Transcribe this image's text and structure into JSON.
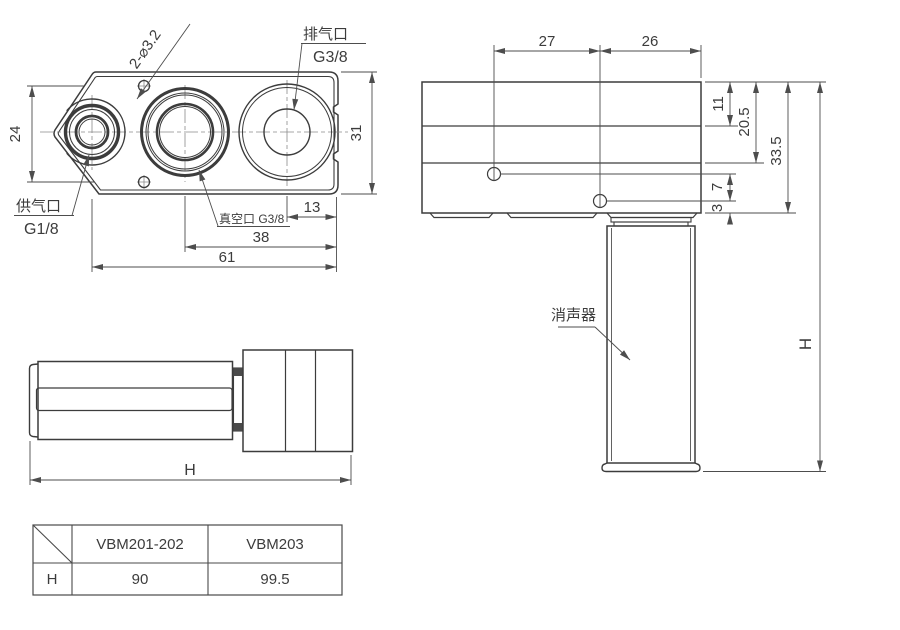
{
  "title": "VBM vacuum generator dimension drawing",
  "colors": {
    "ink": "#3c3c3c",
    "dim_lines": "#4d4d4d",
    "background": "#ffffff"
  },
  "top_view": {
    "hole_callout": "2-⌀3.2",
    "exhaust_port": "排气口",
    "exhaust_thread": "G3/8",
    "supply_port": "供气口",
    "supply_thread": "G1/8",
    "vacuum_port": "真空口 G3/8",
    "dim_hole_spacing": "24",
    "dim_body_width": "31",
    "dim_exhaust_to_edge": "13",
    "dim_vacuum_to_edge": "38",
    "dim_supply_to_edge": "61"
  },
  "right_view": {
    "muffler": "消声器",
    "dim_left": "27",
    "dim_right": "26",
    "dim_top": "11",
    "dim_mid": "20.5",
    "dim_body": "33.5",
    "dim_hole_gap": "7",
    "dim_bottom": "3",
    "dim_total": "H"
  },
  "bottom_view": {
    "dim_total": "H"
  },
  "table": {
    "col_headers": [
      "VBM201-202",
      "VBM203"
    ],
    "row_header": "H",
    "values": [
      "90",
      "99.5"
    ]
  }
}
